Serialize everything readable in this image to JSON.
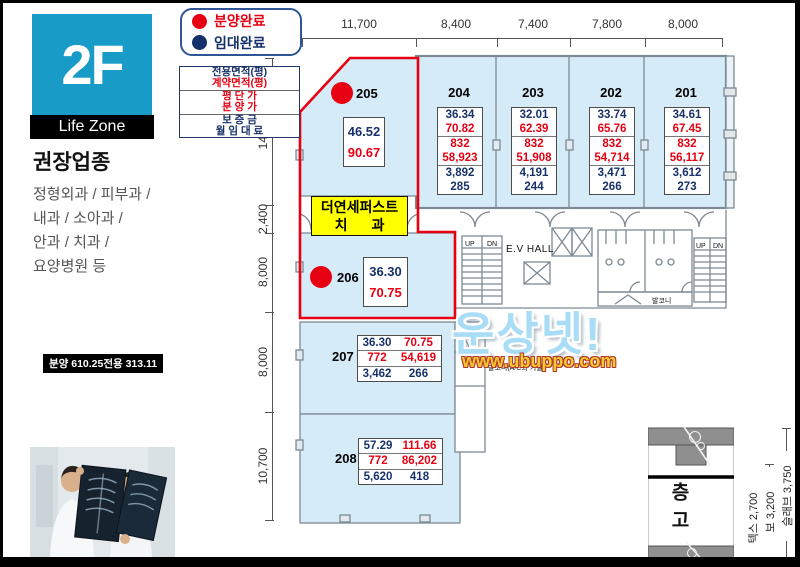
{
  "colors": {
    "accent_red": "#e60012",
    "navy": "#17316b",
    "cyan": "#199bc8",
    "unit_fill": "#d5ebf8",
    "tenant_yellow": "#ffff00"
  },
  "sidebar": {
    "floor_label": "2F",
    "zone_label": "Life Zone",
    "recommend_title": "권장업종",
    "recommend_lines": [
      "정형외과 / 피부과 /",
      "내과 / 소아과 /",
      "안과 / 치과 /",
      "요양병원 등"
    ],
    "area_summary": "분양 610.25전용 313.11"
  },
  "legend": {
    "sold_label": "분양완료",
    "lease_label": "임대완료"
  },
  "info_box": {
    "rows": [
      "전용면적(평)",
      "계약면적(평)",
      "평 단 가",
      "분 양 가",
      "보 증 금",
      "월 임 대 료"
    ]
  },
  "dimensions": {
    "top": [
      "11,700",
      "8,400",
      "7,400",
      "7,800",
      "8,000"
    ],
    "left": [
      "14,300",
      "2,400",
      "8,000",
      "8,000",
      "10,700"
    ]
  },
  "units": {
    "top": [
      {
        "label": "204",
        "exclusive": "36.34",
        "contract": "70.82",
        "unit_price": "832",
        "sale_price": "58,923",
        "deposit": "3,892",
        "rent": "285"
      },
      {
        "label": "203",
        "exclusive": "32.01",
        "contract": "62.39",
        "unit_price": "832",
        "sale_price": "51,908",
        "deposit": "4,191",
        "rent": "244"
      },
      {
        "label": "202",
        "exclusive": "33.74",
        "contract": "65.76",
        "unit_price": "832",
        "sale_price": "54,714",
        "deposit": "3,471",
        "rent": "266"
      },
      {
        "label": "201",
        "exclusive": "34.61",
        "contract": "67.45",
        "unit_price": "832",
        "sale_price": "56,117",
        "deposit": "3,612",
        "rent": "273"
      }
    ],
    "u205": {
      "label": "205",
      "exclusive": "46.52",
      "contract": "90.67",
      "status": "분양완료"
    },
    "u206": {
      "label": "206",
      "exclusive": "36.30",
      "contract": "70.75",
      "status": "분양완료"
    },
    "u207": {
      "label": "207",
      "exclusive": "36.30",
      "contract": "70.75",
      "unit_price": "772",
      "sale_price": "54,619",
      "deposit": "3,462",
      "rent": "266"
    },
    "u208": {
      "label": "208",
      "exclusive": "57.29",
      "contract": "111.66",
      "unit_price": "772",
      "sale_price": "86,202",
      "deposit": "5,620",
      "rent": "418"
    }
  },
  "tenant": {
    "line1": "더연세퍼스트",
    "line2": "치 과"
  },
  "core": {
    "ev_hall": "E.V HALL",
    "up": "UP",
    "dn": "DN",
    "balcony": "발코니",
    "balcony_note": "발코니(A/C외 기실)"
  },
  "watermark": {
    "name": "운상넷!",
    "url": "www.ubuppo.com"
  },
  "section": {
    "title": "층고",
    "labels": [
      "텍스 2,700",
      "보 3,200",
      "슬래브 3,750"
    ]
  }
}
